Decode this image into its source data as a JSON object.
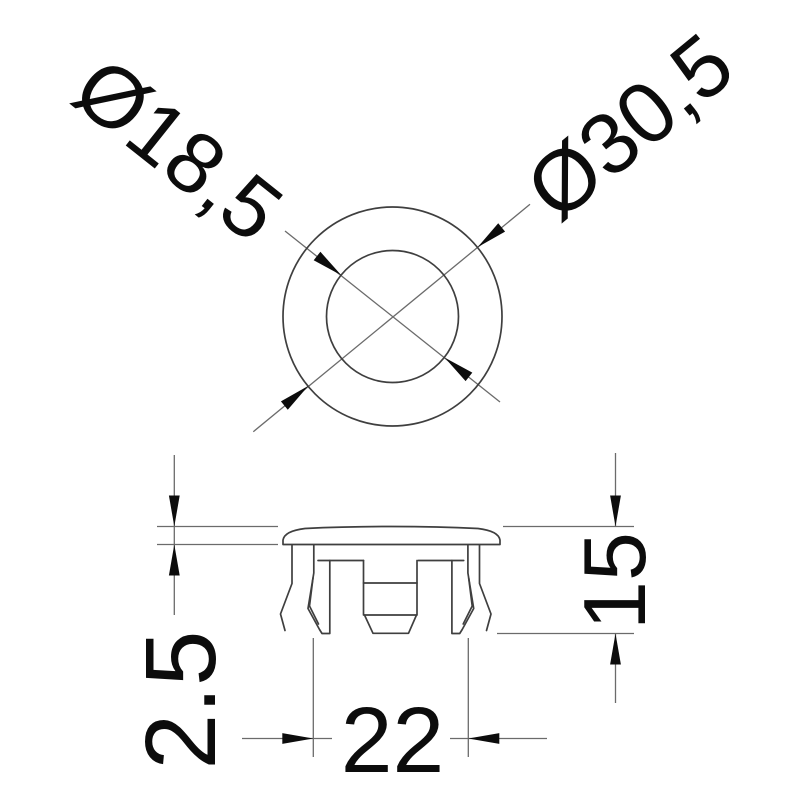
{
  "drawing": {
    "type": "technical-dimension-drawing",
    "colors": {
      "background": "#ffffff",
      "outline": "#3f3f3f",
      "dimension_lines": "#6b6b6b",
      "text": "#0c0c0c"
    },
    "top_view": {
      "inner_diameter_label": "Ø18,5",
      "outer_diameter_label": "Ø30,5"
    },
    "side_view": {
      "rim_thickness_label": "2.5",
      "outer_width_label": "22",
      "overall_height_label": "15"
    }
  }
}
